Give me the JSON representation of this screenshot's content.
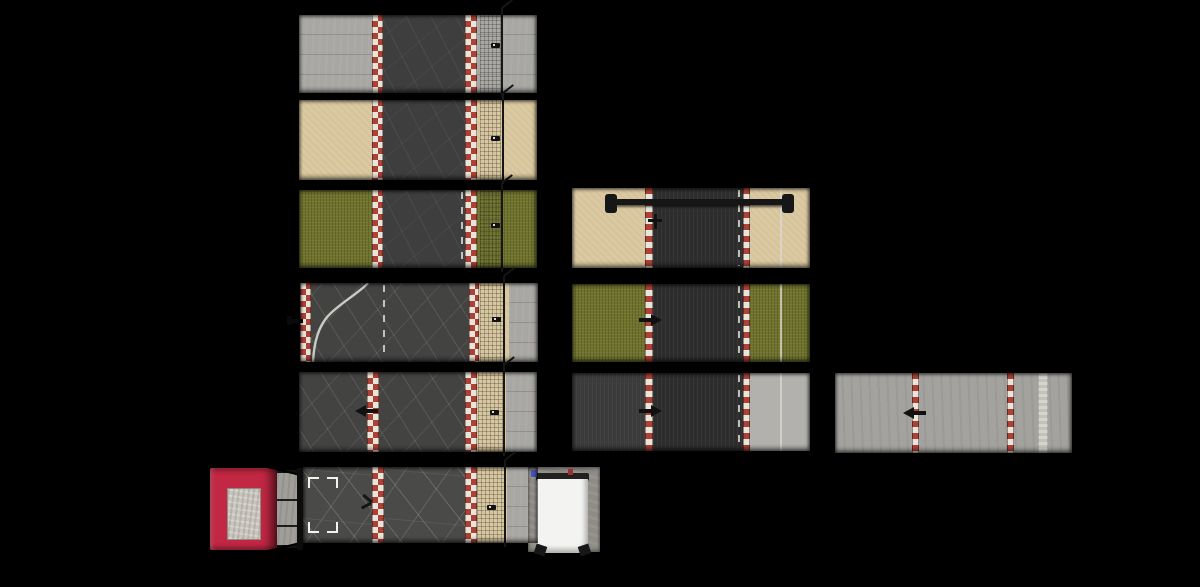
{
  "canvas": {
    "width": 1200,
    "height": 587,
    "background": "#000000"
  },
  "palette": {
    "concrete": "#a8a7a3",
    "grayWide": "#a3a29e",
    "grayLight": "#b2b1ad",
    "sand": "#dbc9a1",
    "grass": "#6f732c",
    "asphalt": "#3e3e3e",
    "cobble": "#434342",
    "cracked": "#4a4a48",
    "asphaltDark": "#2d2d2d",
    "asphaltSide": "#3b3b3b",
    "curbRed": "#ab4137",
    "curbWhite": "#eae5d9",
    "lineWhite": "#d9d8d0",
    "fence": "#161616",
    "gantry": "#161616",
    "marker": "#111111",
    "red": "#c22743",
    "redDark": "#8e1d31",
    "skylight": "#c9c5bd",
    "pad": "#8e8c85",
    "roofWhite": "#f3f3f1",
    "roofEdge": "#212121",
    "ventBlue": "#4653b8",
    "ventRed": "#9c3030"
  },
  "tiles": [
    {
      "name": "tile-straight-concrete",
      "x": 299,
      "y": 15,
      "w": 238,
      "h": 78,
      "layers": [
        {
          "kind": "terrain",
          "name": "verge-left-concrete",
          "fill": "concrete",
          "x": 0,
          "w": 73
        },
        {
          "kind": "curb",
          "name": "curb-left",
          "style": "checker",
          "x": 73,
          "w": 11
        },
        {
          "kind": "road",
          "name": "road-asphalt",
          "fill": "asphalt",
          "x": 84,
          "w": 82
        },
        {
          "kind": "curb",
          "name": "curb-right",
          "style": "checker",
          "x": 166,
          "w": 12
        },
        {
          "kind": "terrain",
          "name": "verge-right-concrete",
          "fill": "concrete",
          "x": 178,
          "w": 60
        },
        {
          "kind": "mesh",
          "name": "fence-mesh",
          "x": 181,
          "w": 21
        },
        {
          "kind": "fence",
          "name": "fence",
          "x": 202
        },
        {
          "kind": "marker",
          "variant": "sign",
          "name": "trackside-sign",
          "x": 192,
          "y": 28
        }
      ]
    },
    {
      "name": "tile-straight-sand",
      "x": 299,
      "y": 100,
      "w": 238,
      "h": 80,
      "layers": [
        {
          "kind": "terrain",
          "name": "verge-left-sand",
          "fill": "sand",
          "x": 0,
          "w": 73
        },
        {
          "kind": "curb",
          "name": "curb-left",
          "style": "checker",
          "x": 73,
          "w": 11
        },
        {
          "kind": "road",
          "name": "road-asphalt",
          "fill": "asphalt",
          "x": 84,
          "w": 82
        },
        {
          "kind": "curb",
          "name": "curb-right",
          "style": "checker",
          "x": 166,
          "w": 12
        },
        {
          "kind": "terrain",
          "name": "verge-right-sand",
          "fill": "sand",
          "x": 178,
          "w": 60
        },
        {
          "kind": "mesh",
          "name": "fence-mesh",
          "x": 181,
          "w": 21
        },
        {
          "kind": "fence",
          "name": "fence",
          "x": 203
        },
        {
          "kind": "marker",
          "variant": "sign",
          "name": "trackside-sign",
          "x": 192,
          "y": 36
        }
      ]
    },
    {
      "name": "tile-straight-grass",
      "x": 299,
      "y": 190,
      "w": 238,
      "h": 78,
      "layers": [
        {
          "kind": "terrain",
          "name": "verge-left-grass",
          "fill": "grass",
          "x": 0,
          "w": 73
        },
        {
          "kind": "curb",
          "name": "curb-left",
          "style": "checker",
          "x": 73,
          "w": 11
        },
        {
          "kind": "road",
          "name": "road-asphalt",
          "fill": "asphalt",
          "x": 84,
          "w": 82
        },
        {
          "kind": "dash",
          "name": "road-dashed-line",
          "x": 162
        },
        {
          "kind": "curb",
          "name": "curb-right",
          "style": "checker",
          "x": 166,
          "w": 12
        },
        {
          "kind": "terrain",
          "name": "verge-right-grass",
          "fill": "grass",
          "x": 178,
          "w": 60
        },
        {
          "kind": "mesh",
          "name": "fence-mesh",
          "x": 181,
          "w": 21
        },
        {
          "kind": "fence",
          "name": "fence",
          "x": 202
        },
        {
          "kind": "marker",
          "variant": "sign",
          "name": "trackside-sign",
          "x": 192,
          "y": 33
        }
      ]
    },
    {
      "name": "tile-pit-entry",
      "x": 300,
      "y": 283,
      "w": 238,
      "h": 79,
      "layers": [
        {
          "kind": "curb",
          "name": "curb-left-edge",
          "style": "checker",
          "x": 0,
          "w": 11
        },
        {
          "kind": "road",
          "name": "road-cobble",
          "fill": "cobble",
          "x": 11,
          "w": 158
        },
        {
          "kind": "dash",
          "name": "road-center-dashed-line",
          "x": 83
        },
        {
          "kind": "curve",
          "name": "pit-entry-line",
          "path": "M68,0 C58,11 40,20 28,33 C19,43 14,58 13,79"
        },
        {
          "kind": "curb",
          "name": "curb-right",
          "style": "checker",
          "x": 169,
          "w": 10
        },
        {
          "kind": "terrain",
          "name": "verge-sand",
          "fill": "sand",
          "x": 179,
          "w": 30
        },
        {
          "kind": "mesh",
          "name": "fence-mesh",
          "x": 180,
          "w": 23
        },
        {
          "kind": "fence",
          "name": "fence",
          "x": 203
        },
        {
          "kind": "terrain",
          "name": "verge-concrete",
          "fill": "concrete",
          "x": 209,
          "w": 29
        },
        {
          "kind": "marker",
          "variant": "pole",
          "name": "pole-marker",
          "x": -13,
          "y": 33
        },
        {
          "kind": "marker",
          "variant": "sign",
          "name": "trackside-sign",
          "x": 192,
          "y": 34
        }
      ]
    },
    {
      "name": "tile-runoff-sand",
      "x": 299,
      "y": 372,
      "w": 238,
      "h": 80,
      "layers": [
        {
          "kind": "road",
          "name": "apron-left-cobble",
          "fill": "cobble",
          "x": 0,
          "w": 68
        },
        {
          "kind": "curb",
          "name": "curb-left",
          "style": "checker",
          "x": 68,
          "w": 12
        },
        {
          "kind": "road",
          "name": "road-cobble",
          "fill": "cobble",
          "x": 80,
          "w": 86
        },
        {
          "kind": "curb",
          "name": "curb-right",
          "style": "checker",
          "x": 166,
          "w": 12
        },
        {
          "kind": "terrain",
          "name": "verge-sand",
          "fill": "sand",
          "x": 178,
          "w": 29
        },
        {
          "kind": "mesh",
          "name": "fence-mesh",
          "x": 179,
          "w": 25
        },
        {
          "kind": "fence",
          "name": "fence",
          "x": 204
        },
        {
          "kind": "terrain",
          "name": "verge-concrete",
          "fill": "concrete",
          "x": 207,
          "w": 31
        },
        {
          "kind": "marker",
          "variant": "arrow",
          "name": "direction-arrow",
          "x": 56,
          "y": 33
        },
        {
          "kind": "marker",
          "variant": "sign",
          "name": "trackside-sign",
          "x": 191,
          "y": 38
        }
      ]
    },
    {
      "name": "tile-start-selected",
      "x": 303,
      "y": 467,
      "w": 235,
      "h": 76,
      "layers": [
        {
          "kind": "road",
          "name": "apron-left-cracked",
          "fill": "cracked",
          "x": 0,
          "w": 69
        },
        {
          "kind": "curb",
          "name": "curb-left",
          "style": "checker",
          "x": 69,
          "w": 12
        },
        {
          "kind": "road",
          "name": "road-cracked",
          "fill": "cracked",
          "x": 81,
          "w": 81
        },
        {
          "kind": "curb",
          "name": "curb-right",
          "style": "checker",
          "x": 162,
          "w": 12
        },
        {
          "kind": "terrain",
          "name": "verge-sand",
          "fill": "sand",
          "x": 174,
          "w": 30
        },
        {
          "kind": "mesh",
          "name": "fence-mesh",
          "x": 174,
          "w": 27
        },
        {
          "kind": "fence",
          "name": "fence",
          "x": 201
        },
        {
          "kind": "terrain",
          "name": "verge-concrete",
          "fill": "concrete",
          "x": 204,
          "w": 31
        },
        {
          "kind": "brackets",
          "name": "selection-brackets",
          "x": 5,
          "y": 10,
          "w": 30,
          "h": 56
        },
        {
          "kind": "marker",
          "variant": "bird",
          "name": "small-object",
          "x": 57,
          "y": 28
        },
        {
          "kind": "marker",
          "variant": "sign",
          "name": "trackside-sign",
          "x": 184,
          "y": 38
        }
      ]
    },
    {
      "name": "tile-gantry-sand",
      "x": 572,
      "y": 188,
      "w": 238,
      "h": 80,
      "layers": [
        {
          "kind": "terrain",
          "name": "verge-left-sand",
          "fill": "sand",
          "x": 0,
          "w": 73
        },
        {
          "kind": "curb",
          "name": "curb-left",
          "style": "single",
          "x": 73,
          "w": 8
        },
        {
          "kind": "road",
          "name": "road-dark",
          "fill": "asphaltDark",
          "x": 81,
          "w": 90
        },
        {
          "kind": "dash",
          "name": "road-dashed-line",
          "x": 166
        },
        {
          "kind": "curb",
          "name": "curb-right",
          "style": "single",
          "x": 171,
          "w": 7
        },
        {
          "kind": "terrain",
          "name": "verge-right-sand",
          "fill": "sand",
          "x": 178,
          "w": 60
        },
        {
          "kind": "solid",
          "name": "edge-line",
          "x": 208
        },
        {
          "kind": "marker",
          "variant": "cross",
          "name": "signal-marker",
          "x": 76,
          "y": 26
        },
        {
          "kind": "gantry",
          "name": "overhead-gantry",
          "bar": {
            "x": 44,
            "y": 11,
            "w": 168,
            "h": 6
          },
          "caps": [
            {
              "x": 33,
              "y": 6
            },
            {
              "x": 210,
              "y": 6
            }
          ]
        }
      ]
    },
    {
      "name": "tile-straight-grass-dark",
      "x": 572,
      "y": 284,
      "w": 238,
      "h": 78,
      "layers": [
        {
          "kind": "terrain",
          "name": "verge-left-grass",
          "fill": "grass",
          "x": 0,
          "w": 73
        },
        {
          "kind": "curb",
          "name": "curb-left",
          "style": "single",
          "x": 73,
          "w": 8
        },
        {
          "kind": "road",
          "name": "road-dark",
          "fill": "asphaltDark",
          "x": 81,
          "w": 90
        },
        {
          "kind": "dash",
          "name": "road-dashed-line",
          "x": 166
        },
        {
          "kind": "curb",
          "name": "curb-right",
          "style": "single",
          "x": 171,
          "w": 7
        },
        {
          "kind": "terrain",
          "name": "verge-right-grass",
          "fill": "grass",
          "x": 178,
          "w": 60
        },
        {
          "kind": "solid",
          "name": "edge-line",
          "x": 208
        },
        {
          "kind": "marker",
          "variant": "arrow",
          "flip": true,
          "name": "direction-arrow",
          "x": 66,
          "y": 30
        }
      ]
    },
    {
      "name": "tile-straight-gray",
      "x": 572,
      "y": 373,
      "w": 238,
      "h": 78,
      "layers": [
        {
          "kind": "terrain",
          "name": "verge-left-asphalt",
          "fill": "asphaltSide",
          "x": 0,
          "w": 73
        },
        {
          "kind": "curb",
          "name": "curb-left",
          "style": "single",
          "x": 73,
          "w": 8
        },
        {
          "kind": "road",
          "name": "road-dark",
          "fill": "asphaltDark",
          "x": 81,
          "w": 90
        },
        {
          "kind": "dash",
          "name": "road-dashed-line",
          "x": 166
        },
        {
          "kind": "curb",
          "name": "curb-right",
          "style": "single",
          "x": 171,
          "w": 7
        },
        {
          "kind": "terrain",
          "name": "verge-right-gray",
          "fill": "grayLight",
          "x": 178,
          "w": 60
        },
        {
          "kind": "solid",
          "name": "edge-line",
          "x": 208
        },
        {
          "kind": "marker",
          "variant": "arrow",
          "flip": true,
          "name": "direction-arrow",
          "x": 66,
          "y": 32
        }
      ]
    },
    {
      "name": "tile-wide-concrete",
      "x": 835,
      "y": 373,
      "w": 237,
      "h": 80,
      "layers": [
        {
          "kind": "terrain",
          "name": "concrete-surface",
          "fill": "grayWide",
          "x": 0,
          "w": 237
        },
        {
          "kind": "curb",
          "name": "curb-left",
          "style": "single",
          "x": 77,
          "w": 7
        },
        {
          "kind": "curb",
          "name": "curb-right",
          "style": "single",
          "x": 172,
          "w": 7
        },
        {
          "kind": "strip",
          "name": "painted-strip",
          "x": 203,
          "w": 10
        },
        {
          "kind": "marker",
          "variant": "arrow",
          "name": "direction-arrow",
          "x": 68,
          "y": 34
        }
      ]
    }
  ],
  "buildings": {
    "red_garage": {
      "name": "red-garage",
      "x": 210,
      "y": 468,
      "w": 93,
      "h": 82,
      "roof_w": 67,
      "skylight": {
        "x": 17,
        "y": 20,
        "w": 32,
        "h": 50
      },
      "dock": {
        "x": 67,
        "w": 20,
        "lines_y": [
          26,
          52
        ]
      },
      "dark_edge": {
        "x": 87,
        "w": 6
      },
      "diagonals": [
        {
          "x": 58,
          "y": -2,
          "w": 30,
          "rot": 14
        },
        {
          "x": 58,
          "y": 82,
          "w": 30,
          "rot": -14
        }
      ]
    },
    "white_garage": {
      "name": "white-garage",
      "x": 528,
      "y": 467,
      "w": 72,
      "h": 89,
      "pad": {
        "x": 0,
        "y": 0,
        "w": 72,
        "h": 85
      },
      "roof": {
        "x": 9,
        "y": 12,
        "w": 51,
        "h": 74
      },
      "roof_top": {
        "x": 8,
        "y": 6,
        "w": 53,
        "h": 8
      },
      "vents": [
        {
          "name": "vent-blue",
          "x": 3,
          "y": 3,
          "w": 6,
          "h": 7,
          "fill": "ventBlue"
        },
        {
          "name": "vent-red",
          "x": 40,
          "y": 2,
          "w": 5,
          "h": 6,
          "fill": "ventRed"
        }
      ]
    }
  }
}
